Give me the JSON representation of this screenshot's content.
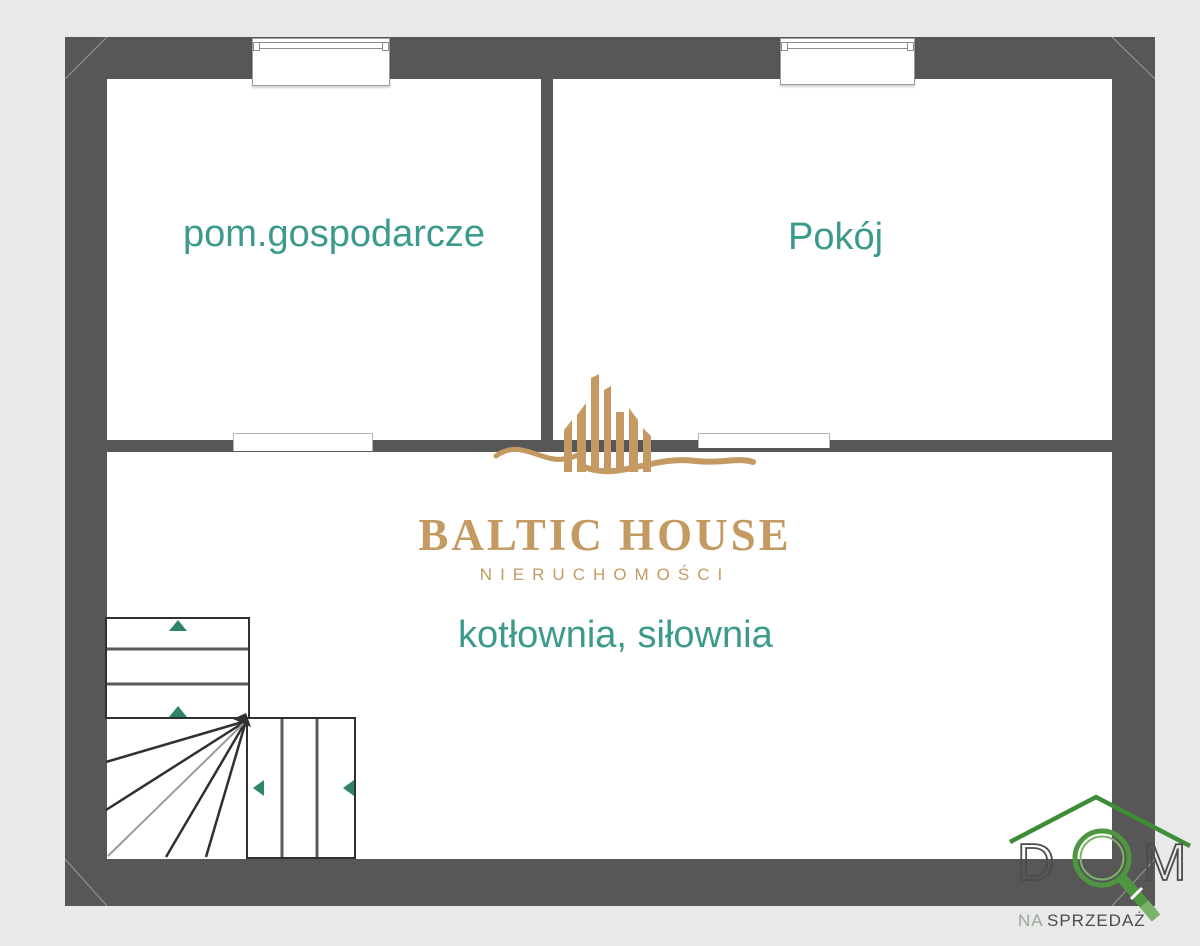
{
  "plan": {
    "type": "floor-plan",
    "rooms": [
      {
        "id": "pom-gospodarcze",
        "label": "pom.gospodarcze"
      },
      {
        "id": "pokoj",
        "label": "Pokój"
      },
      {
        "id": "kotlownia-silownia",
        "label": "kotłownia, siłownia"
      }
    ],
    "colors": {
      "wall": "#575757",
      "floor": "#ffffff",
      "background": "#e9e9e9",
      "room_label": "#3c9a8c",
      "stair_arrow": "#2f8468"
    },
    "features": {
      "windows_top_wall": 2,
      "door_openings": 2,
      "stairs": "L-shaped winder staircase, bottom-left"
    }
  },
  "watermark": {
    "name": "BALTIC HOUSE",
    "subtitle": "NIERUCHOMOŚCI",
    "gold": "#c49a62"
  },
  "agency_badge": {
    "letter_d": "D",
    "letter_m": "M",
    "tagline_na": "NA",
    "tagline_sprzedaz": "SPRZEDAŻ",
    "green": "#4f9641",
    "light_green": "#7bb36a",
    "dark": "#4b4b50"
  }
}
